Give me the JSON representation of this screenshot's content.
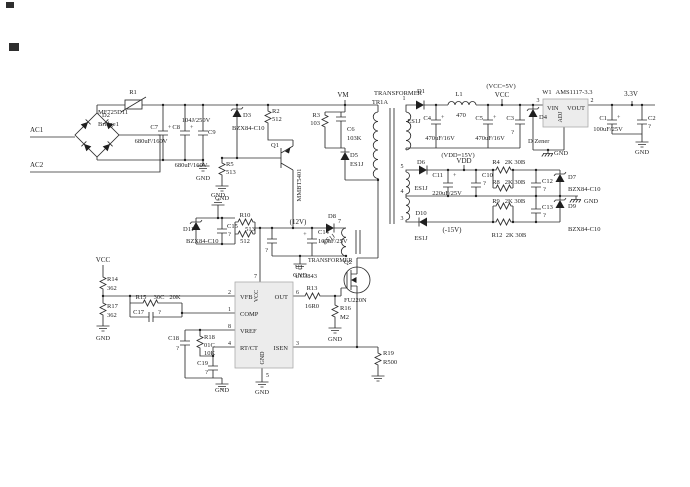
{
  "labels": {
    "ac1": "AC1",
    "ac2": "AC2",
    "r1": "R1",
    "r1v": "MF725D11",
    "d2": "D2",
    "d2v": "Bridge1",
    "c7": "C7",
    "c8": "C8",
    "c9": "C9",
    "c78v": "680uF/160V",
    "c9v": "104J/250V",
    "plus": "+",
    "d3": "D3",
    "bzx": "BZX84-C10",
    "r2": "R2",
    "v512": "512",
    "r5": "R5",
    "v513": "513",
    "q1": "Q1",
    "q1v": "MMBT5401",
    "gnd": "GND",
    "vm": "VM",
    "r3": "R3",
    "r3v": "103",
    "c6": "C6",
    "c6v": "103K",
    "d5": "D5",
    "es1j": "ES1J",
    "transformer": "TRANSFORMER",
    "tr1a": "TR1A",
    "p1": "1",
    "p2": "2",
    "p3": "3",
    "p4": "4",
    "p5": "5",
    "p6": "6",
    "p7": "7",
    "p8": "8",
    "d1": "D1",
    "l1": "L1",
    "l1v": "470",
    "c4": "C4",
    "c5": "C5",
    "c45v": "470uF/16V",
    "vddeq": "(VDD=15V)",
    "vdd": "VDD",
    "vcceq": "(VCC=5V)",
    "vcc": "VCC",
    "c3": "C3",
    "q": "?",
    "w1": "W1",
    "ams": "AMS1117-3.3",
    "vin": "VIN",
    "voutl": "VOUT",
    "adj": "ADJ",
    "v33": "3.3V",
    "c1": "C1",
    "c100v": "100uF/25V",
    "c2": "C2",
    "d4": "D4",
    "d4v": "D Zener",
    "d6": "D6",
    "c11": "C11",
    "c11v": "220uF/25V",
    "c10": "C10",
    "r4": "R4",
    "r8": "R8",
    "r9": "R9",
    "r12": "R12",
    "r2k": "2K 30B",
    "c12": "C12",
    "c13": "C13",
    "d7": "D7",
    "d9": "D9",
    "d10": "D10",
    "neg15": "(-15V)",
    "d11": "D11",
    "c15": "C15",
    "r10": "R10",
    "v12": "(12V)",
    "c14": "C14",
    "d8": "D8",
    "u1": "U1",
    "ic": "UC3843",
    "vfb": "VFB",
    "comp": "COMP",
    "vref": "VREF",
    "rtct": "RT/CT",
    "out": "OUT",
    "isen": "ISEN",
    "r13": "R13",
    "r13v": "16R0",
    "q2": "Q2",
    "q2v": "FU220N",
    "r16": "R16",
    "r16v": "M2",
    "r19": "R19",
    "r19v": "R500",
    "r14": "R14",
    "r17": "R17",
    "v362": "362",
    "r15": "R15",
    "r15c": "30C",
    "r15v": "20K",
    "c17": "C17",
    "c18": "C18",
    "c19": "C19",
    "r18": "R18",
    "r18c": "01C",
    "r18v": "10K"
  }
}
